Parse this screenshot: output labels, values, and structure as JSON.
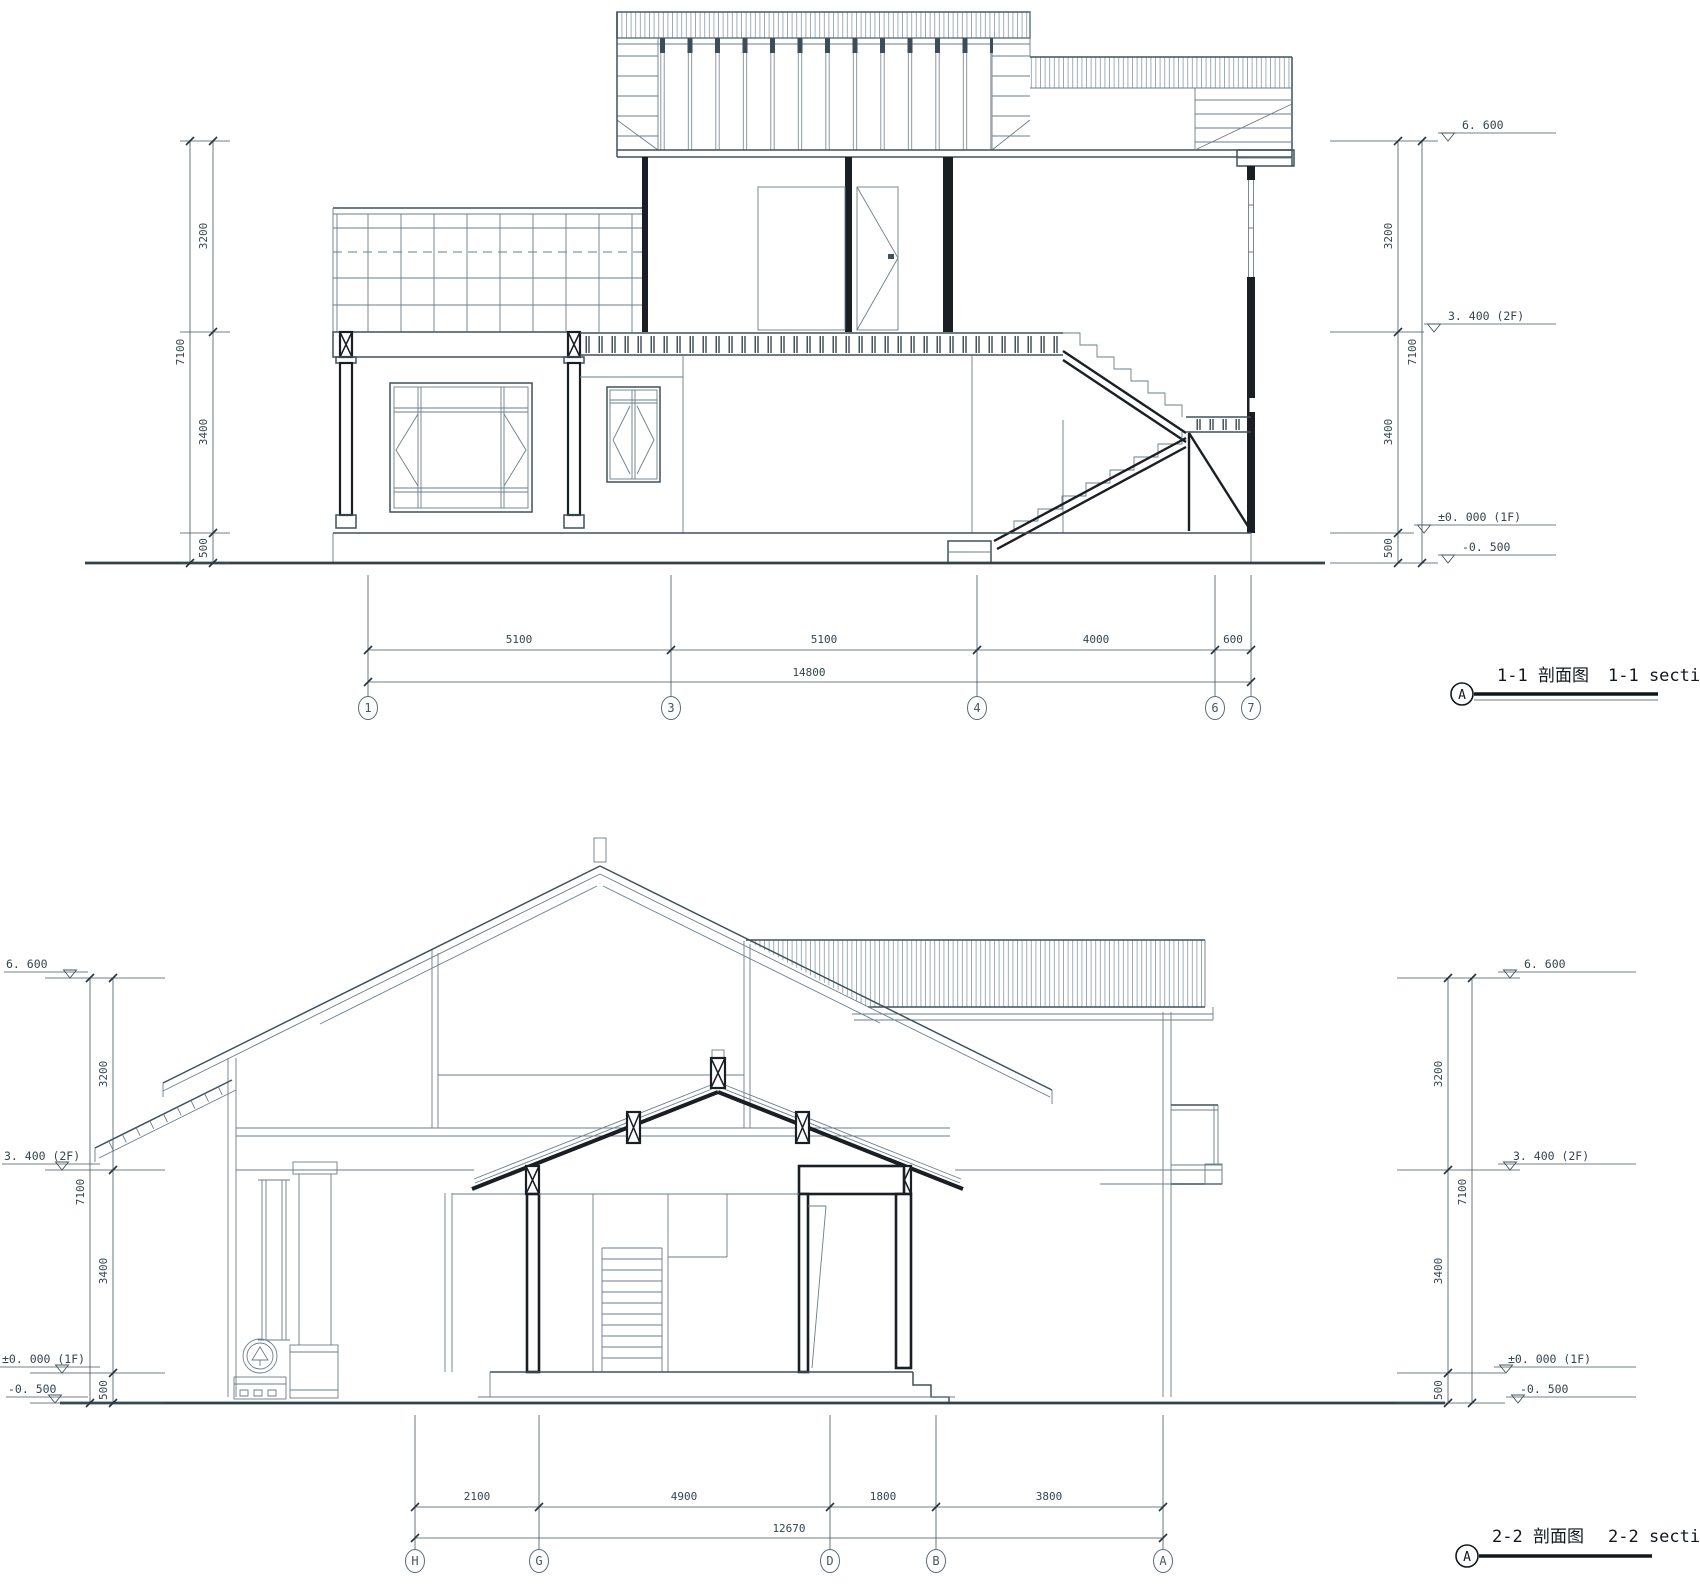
{
  "document": {
    "type": "architectural section drawings",
    "background": "#ffffff",
    "thin_line_color": "#6a7e8b",
    "cut_line_color": "#191f24",
    "annotation_color": "#44565f"
  },
  "section1": {
    "name_zh": "1-1 剖面图",
    "name_en": "1-1 section",
    "detail_marker": "A",
    "grid_labels": [
      "1",
      "3",
      "4",
      "6",
      "7"
    ],
    "span_dims": [
      "5100",
      "5100",
      "4000",
      "600"
    ],
    "span_total": "14800",
    "height_dims": [
      "3200",
      "3400",
      "500"
    ],
    "height_total": "7100",
    "levels": {
      "roof": "6. 600",
      "floor2": "3. 400 (2F)",
      "floor1": "±0. 000 (1F)",
      "ground": "-0. 500"
    }
  },
  "section2": {
    "name_zh": "2-2 剖面图",
    "name_en": "2-2 section",
    "detail_marker": "A",
    "grid_labels": [
      "H",
      "G",
      "D",
      "B",
      "A"
    ],
    "span_dims": [
      "2100",
      "4900",
      "1800",
      "3800"
    ],
    "span_total": "12670",
    "height_dims": [
      "3200",
      "3400",
      "500"
    ],
    "height_total": "7100",
    "levels": {
      "roof": "6. 600",
      "floor2": "3. 400 (2F)",
      "floor1": "±0. 000 (1F)",
      "ground": "-0. 500"
    }
  }
}
